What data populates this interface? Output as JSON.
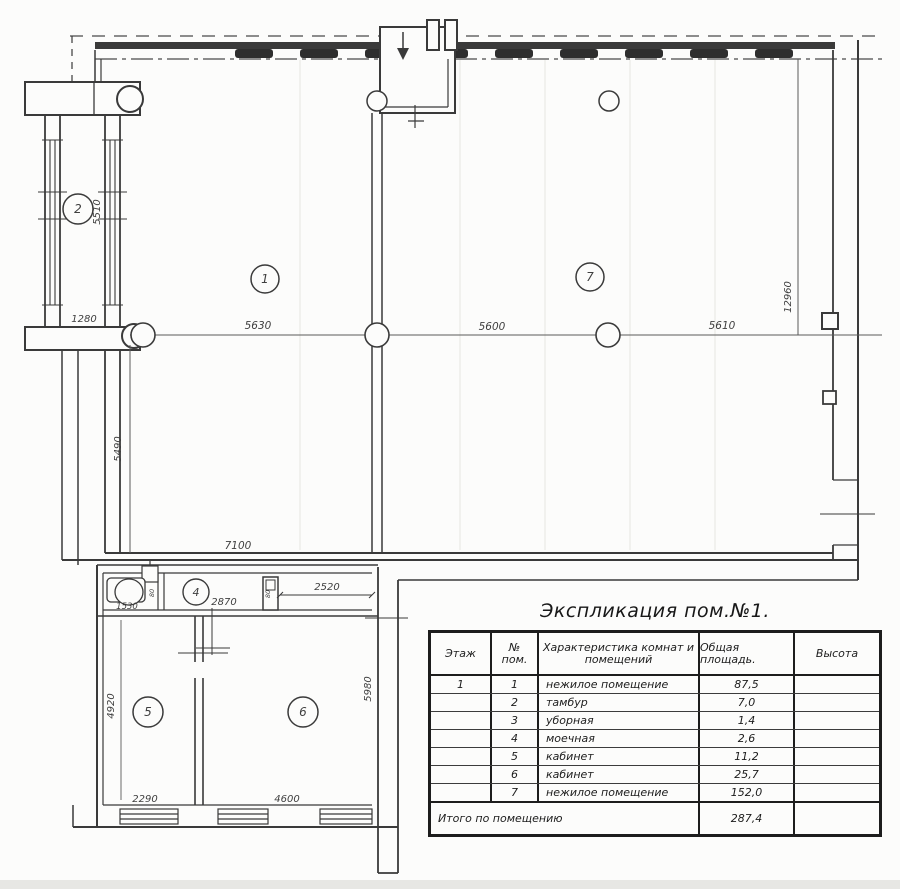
{
  "plan": {
    "rooms": {
      "r1": "1",
      "r2": "2",
      "r4": "4",
      "r5": "5",
      "r6": "6",
      "r7": "7"
    },
    "dims": {
      "porch_width": "1280",
      "tambour_length": "5510",
      "span1": "5630",
      "span2": "5600",
      "span3": "5610",
      "right_height": "12960",
      "left_height": "5490",
      "bottom_width": "7100",
      "toilet_width": "1530",
      "washroom_width": "2870",
      "corridor_width": "2520",
      "door1": "80",
      "door2": "80",
      "room5_height": "4920",
      "room5_width": "2290",
      "room6_width": "4600",
      "room6_height": "5980"
    }
  },
  "explication": {
    "title": "Экспликация пом.№1.",
    "headers": {
      "floor": "Этаж",
      "num_1": "№",
      "num_2": "пом.",
      "desc_1": "Характеристика комнат и",
      "desc_2": "помещений",
      "area": "Общая площадь.",
      "height": "Высота"
    },
    "rows": [
      {
        "floor": "1",
        "num": "1",
        "desc": "нежилое помещение",
        "area": "87,5",
        "height": ""
      },
      {
        "floor": "",
        "num": "2",
        "desc": "тамбур",
        "area": "7,0",
        "height": ""
      },
      {
        "floor": "",
        "num": "3",
        "desc": "уборная",
        "area": "1,4",
        "height": ""
      },
      {
        "floor": "",
        "num": "4",
        "desc": "моечная",
        "area": "2,6",
        "height": ""
      },
      {
        "floor": "",
        "num": "5",
        "desc": "кабинет",
        "area": "11,2",
        "height": ""
      },
      {
        "floor": "",
        "num": "6",
        "desc": "кабинет",
        "area": "25,7",
        "height": ""
      },
      {
        "floor": "",
        "num": "7",
        "desc": "нежилое помещение",
        "area": "152,0",
        "height": ""
      }
    ],
    "total": {
      "label": "Итого по помещению",
      "area": "287,4",
      "height": ""
    }
  }
}
